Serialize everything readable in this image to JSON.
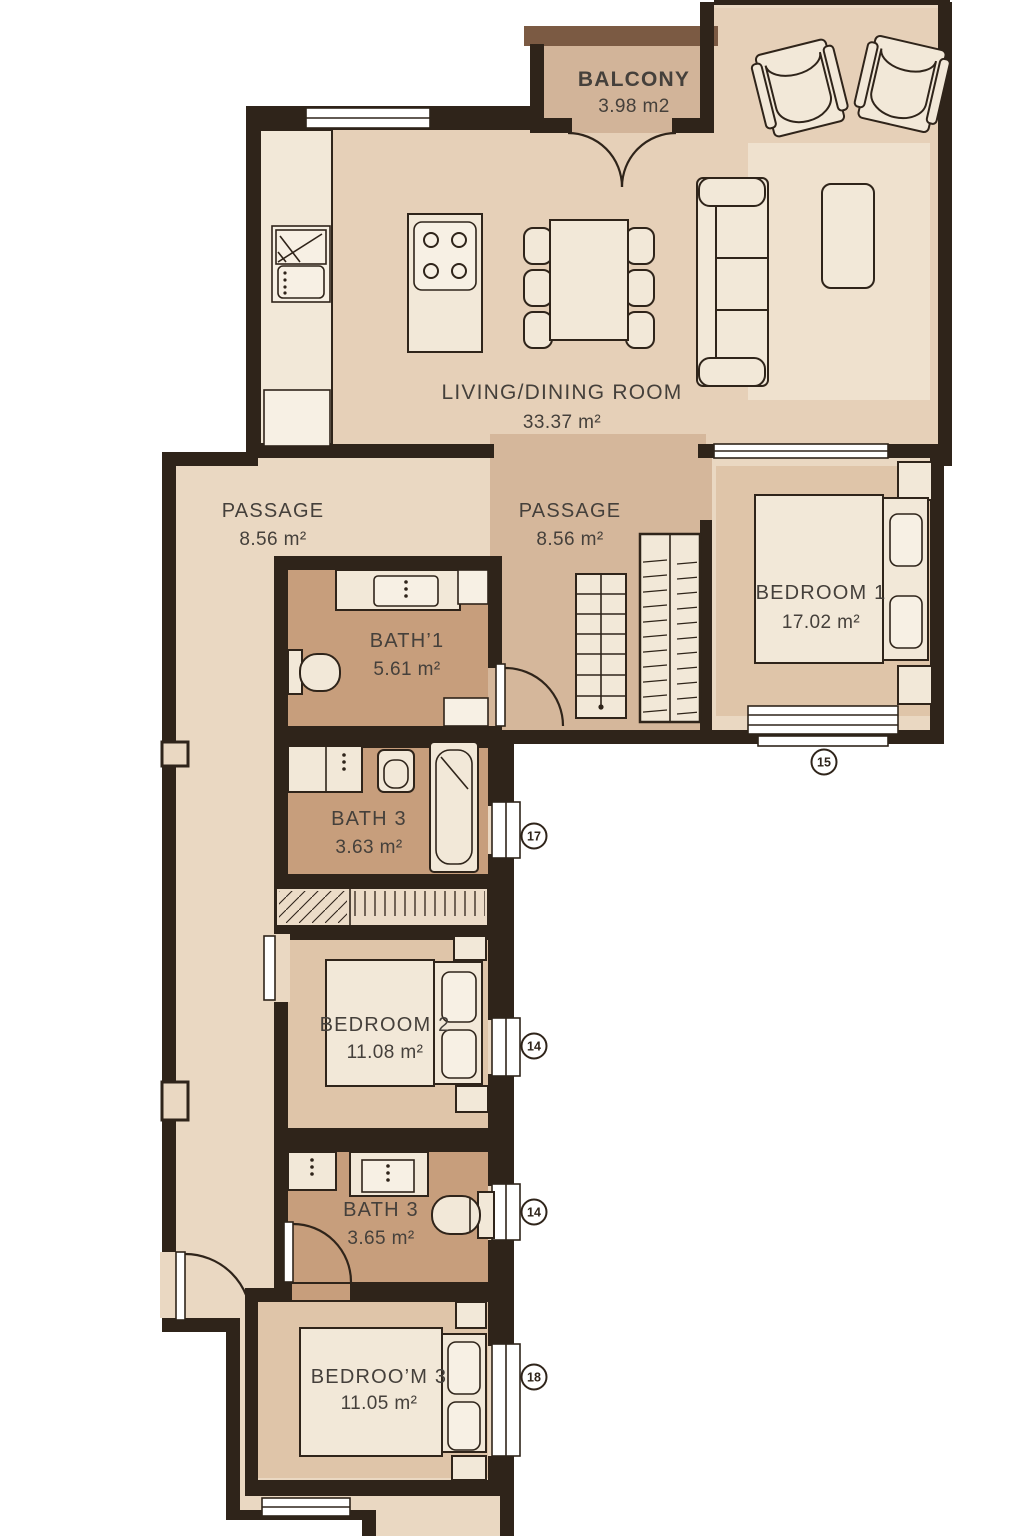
{
  "plan": {
    "title": "apartment-floor-plan",
    "rooms": [
      {
        "id": "balcony",
        "name": "BALCONY",
        "area": "3.98 m2"
      },
      {
        "id": "living",
        "name": "LIVING/DINING ROOM",
        "area": "33.37 m²"
      },
      {
        "id": "passage_left",
        "name": "PASSAGE",
        "area": "8.56 m²"
      },
      {
        "id": "passage_right",
        "name": "PASSAGE",
        "area": "8.56 m²"
      },
      {
        "id": "bath1",
        "name": "BATH’1",
        "area": "5.61 m²"
      },
      {
        "id": "bedroom1",
        "name": "BEDROOM 1",
        "area": "17.02 m²"
      },
      {
        "id": "bath3_upper",
        "name": "BATH 3",
        "area": "3.63 m²"
      },
      {
        "id": "bedroom2",
        "name": "BEDROOM 2",
        "area": "11.08 m²"
      },
      {
        "id": "bath3_lower",
        "name": "BATH 3",
        "area": "3.65 m²"
      },
      {
        "id": "bedroom3",
        "name": "BEDROO’M 3",
        "area": "11.05 m²"
      }
    ],
    "markers": [
      {
        "label": "15"
      },
      {
        "label": "17"
      },
      {
        "label": "14"
      },
      {
        "label": "14"
      },
      {
        "label": "18"
      }
    ],
    "colors": {
      "wall": "#2f241a",
      "floor": "#ead8c2",
      "floor_living": "#e6d0b8",
      "passage_accent": "#d5b79b",
      "bath_accent": "#c79e7c",
      "bedroom_accent": "#dfc5a9",
      "balcony_fill": "#d2b499",
      "balcony_wall": "#7b5a43",
      "furniture": "#f2e8d8",
      "rug": "#efe1ce",
      "text": "#45403b"
    }
  }
}
